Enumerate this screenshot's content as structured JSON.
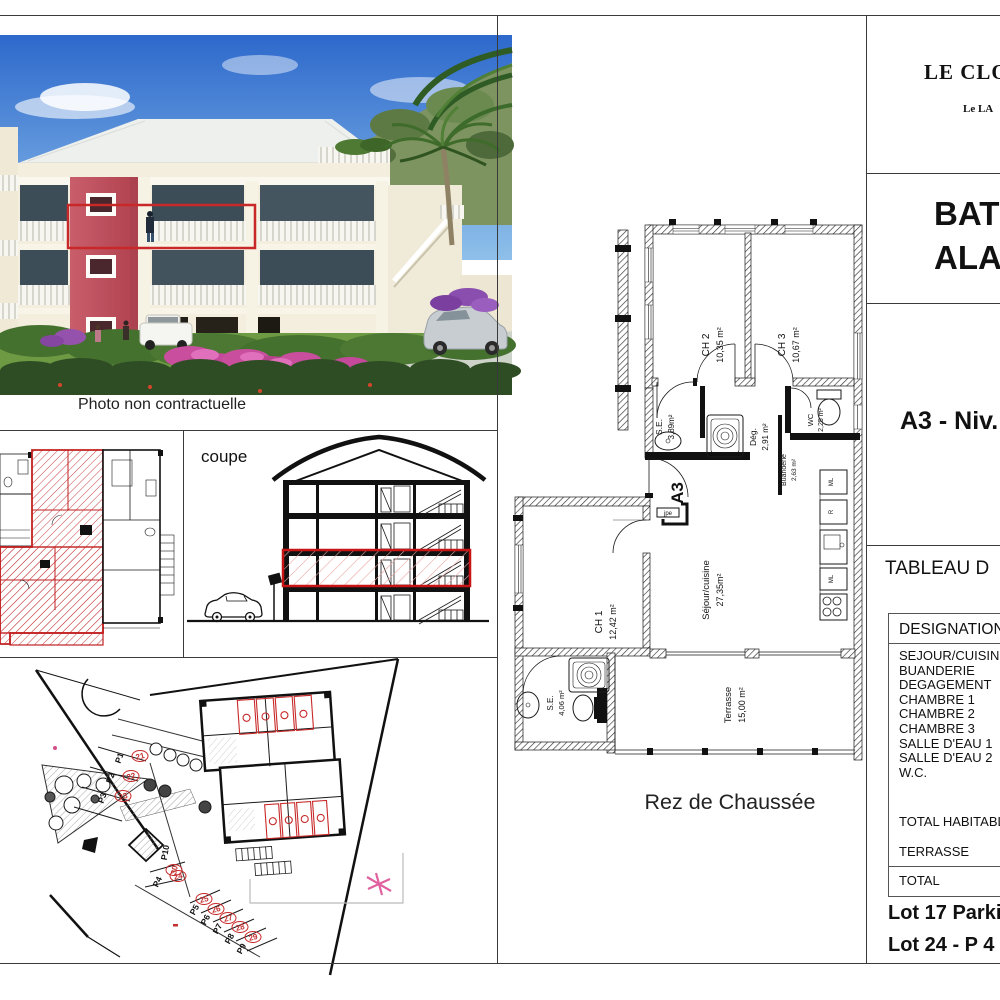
{
  "sheet": {
    "photo_caption": "Photo non contractuelle",
    "coupe_label": "coupe",
    "plan_caption": "Rez de Chaussée"
  },
  "title_block": {
    "project_title": "LE CLOS",
    "project_subtitle": "Le LA",
    "building_line1": "BATI",
    "building_line2": "ALAM",
    "level_ref": "A3 - Niv.",
    "table_title": "TABLEAU D",
    "table": {
      "header": "DESIGNATION",
      "rooms": [
        "SEJOUR/CUISINE",
        "BUANDERIE",
        "DEGAGEMENT",
        "CHAMBRE 1",
        "CHAMBRE 2",
        "CHAMBRE 3",
        "SALLE D'EAU 1",
        "SALLE D'EAU 2",
        "W.C."
      ],
      "total_habitable": "TOTAL HABITABLE",
      "terrasse": "TERRASSE",
      "total": "TOTAL"
    },
    "lot_line1": "Lot 17 Parki",
    "lot_line2": "Lot 24 - P 4"
  },
  "floor_plan": {
    "apartment_label": "A3",
    "door_tag": "jpe",
    "rooms": [
      {
        "name": "CH 2",
        "area": "10,35 m²"
      },
      {
        "name": "CH 3",
        "area": "10,67 m²"
      },
      {
        "name": "S.E.",
        "area": "3,89m²"
      },
      {
        "name": "Dég.",
        "area": "2,91 m²"
      },
      {
        "name": "WC",
        "area": "2,25 m²"
      },
      {
        "name": "Buanderie",
        "area": "2,63 m²"
      },
      {
        "name": "CH 1",
        "area": "12,42 m²"
      },
      {
        "name": "Séjour/cuisine",
        "area": "27,35m²"
      },
      {
        "name": "S.E.",
        "area": "4,06 m²"
      },
      {
        "name": "Terrasse",
        "area": "15,00 m²"
      }
    ],
    "appliances": [
      "ML",
      "R",
      "ML"
    ]
  },
  "site_plan": {
    "stalls": [
      {
        "label": "P1",
        "num": "21"
      },
      {
        "label": "P2",
        "num": "22"
      },
      {
        "label": "P3",
        "num": "23"
      },
      {
        "label": "P4",
        "num": "24"
      },
      {
        "label": "P5",
        "num": "25"
      },
      {
        "label": "P6",
        "num": "26"
      },
      {
        "label": "P7",
        "num": "27"
      },
      {
        "label": "P8",
        "num": "28"
      },
      {
        "label": "P9",
        "num": "29"
      },
      {
        "label": "P10",
        "num": "30"
      }
    ]
  },
  "colors": {
    "highlight_red": "#d01414",
    "line": "#1a1a1a",
    "sky_blue": "#2d69cc",
    "building_cream": "#f3eedd",
    "tower_red": "#c45560",
    "bougainvillea_pink": "#c94f9e"
  }
}
